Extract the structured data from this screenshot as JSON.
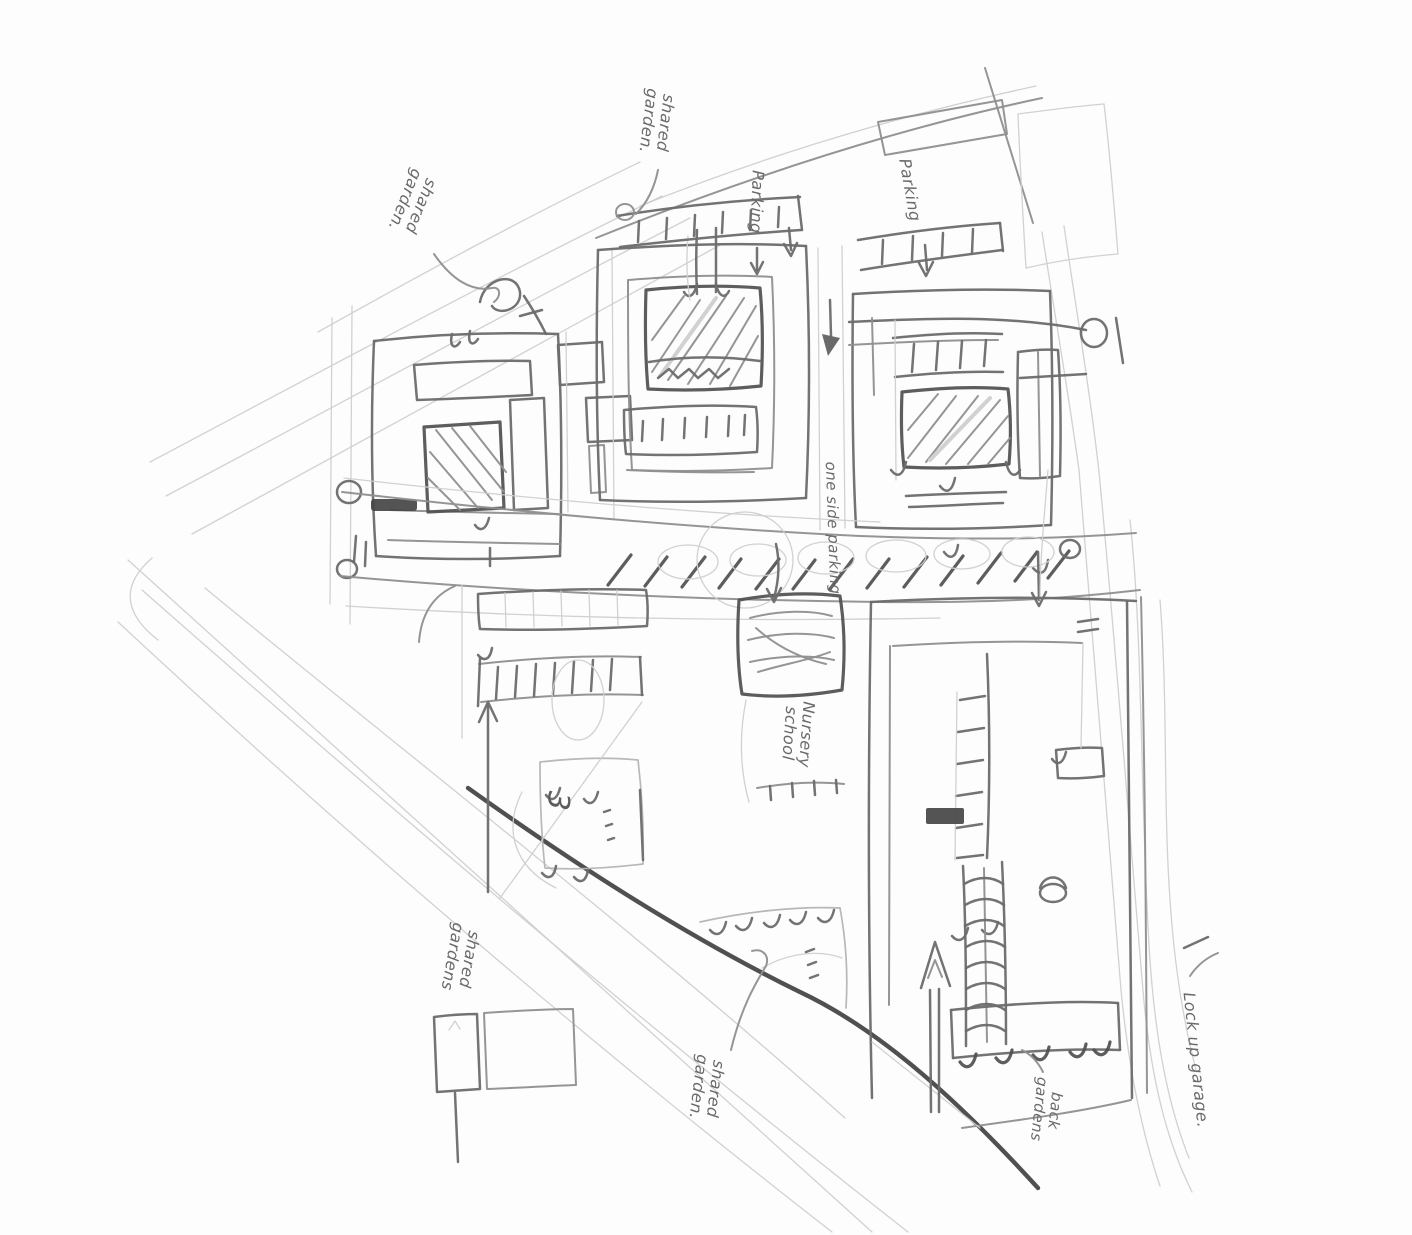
{
  "sketch": {
    "title": "Hand-drawn housing masterplan site sketch",
    "colors": {
      "paper": "#fdfdfd",
      "pencil_light": "#cfcfcf",
      "pencil_mid": "#8f8f8f",
      "pencil_dark": "#6b6b6b",
      "ink": "#4f4f4f",
      "bold": "#3d3d3d",
      "handwriting": "#6a6a6a"
    },
    "annotations": {
      "top_left": {
        "lines": [
          "shared",
          "garden."
        ]
      },
      "top_mid": {
        "lines": [
          "shared",
          "garden."
        ]
      },
      "parking_left": {
        "lines": [
          "Parking"
        ]
      },
      "parking_right": {
        "lines": [
          "Parking"
        ]
      },
      "one_side_parking": {
        "lines": [
          "one side parking"
        ]
      },
      "nursery": {
        "lines": [
          "Nursery",
          "school"
        ]
      },
      "bottom_left": {
        "lines": [
          "shared",
          "gardens"
        ]
      },
      "bottom_mid": {
        "lines": [
          "shared",
          "garden."
        ]
      },
      "back_gardens": {
        "lines": [
          "back",
          "gardens"
        ]
      },
      "lock_up_garage": {
        "lines": [
          "Lock up garage."
        ]
      },
      "storey_mark": {
        "lines": [
          "3"
        ]
      }
    }
  }
}
